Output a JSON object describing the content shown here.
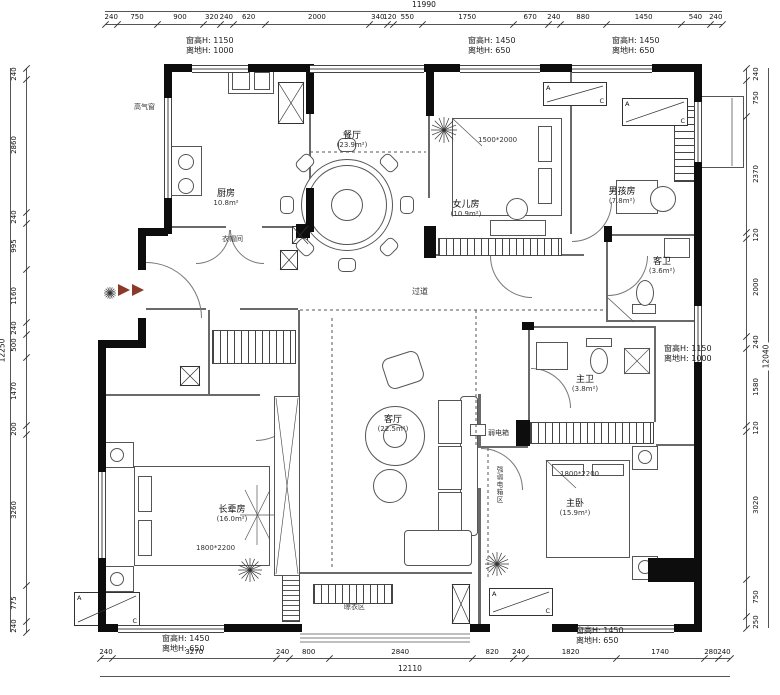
{
  "dims": {
    "top": {
      "total": "11990",
      "values": [
        "240",
        "750",
        "900",
        "320",
        "240",
        "620",
        "2000",
        "340",
        "120",
        "550",
        "1750",
        "670",
        "240",
        "880",
        "1450",
        "540",
        "240"
      ]
    },
    "bottom": {
      "total": "12110",
      "values": [
        "240",
        "3270",
        "240",
        "800",
        "2840",
        "820",
        "240",
        "1820",
        "1740",
        "280",
        "240"
      ]
    },
    "left": {
      "total": "12250",
      "values": [
        "240",
        "2860",
        "240",
        "995",
        "1160",
        "240",
        "500",
        "1470",
        "200",
        "3260",
        "775",
        "240"
      ]
    },
    "right": {
      "total": "12040",
      "values": [
        "240",
        "750",
        "2370",
        "120",
        "2000",
        "240",
        "1580",
        "120",
        "3020",
        "750",
        "250"
      ]
    }
  },
  "window_notes": [
    {
      "x": 186,
      "y": 36,
      "l1": "窗高H: 1150",
      "l2": "离地H: 1000"
    },
    {
      "x": 468,
      "y": 36,
      "l1": "窗高H: 1450",
      "l2": "离地H: 650"
    },
    {
      "x": 612,
      "y": 36,
      "l1": "窗高H: 1450",
      "l2": "离地H: 650"
    },
    {
      "x": 664,
      "y": 344,
      "l1": "窗高H: 1150",
      "l2": "离地H: 1000"
    },
    {
      "x": 162,
      "y": 634,
      "l1": "窗高H: 1450",
      "l2": "离地H: 650"
    },
    {
      "x": 576,
      "y": 626,
      "l1": "窗高H: 1450",
      "l2": "离地H: 650"
    }
  ],
  "rooms": [
    {
      "name": "厨房",
      "area": "10.8m²",
      "x": 226,
      "y": 198
    },
    {
      "name": "餐厅",
      "area": "(23.9m²)",
      "x": 352,
      "y": 140
    },
    {
      "name": "女儿房",
      "area": "(10.9m²)",
      "x": 466,
      "y": 209
    },
    {
      "name": "男孩房",
      "area": "(7.8m²)",
      "x": 622,
      "y": 196
    },
    {
      "name": "客卫",
      "area": "(3.6m²)",
      "x": 662,
      "y": 266
    },
    {
      "name": "主卫",
      "area": "(3.8m²)",
      "x": 585,
      "y": 384
    },
    {
      "name": "客厅",
      "area": "(22.5m²)",
      "x": 393,
      "y": 424
    },
    {
      "name": "主卧",
      "area": "(15.9m²)",
      "x": 575,
      "y": 508
    },
    {
      "name": "长辈房",
      "area": "(16.0m²)",
      "x": 232,
      "y": 514
    }
  ],
  "labels": [
    {
      "t": "过道",
      "x": 412,
      "y": 286,
      "fs": 8
    },
    {
      "t": "衣帽间",
      "x": 222,
      "y": 234,
      "fs": 7
    },
    {
      "t": "晾衣区",
      "x": 344,
      "y": 602,
      "fs": 7
    },
    {
      "t": "弱电箱",
      "x": 488,
      "y": 428,
      "fs": 7
    },
    {
      "t": "高气窗",
      "x": 134,
      "y": 102,
      "fs": 7
    },
    {
      "t": "1500*2000",
      "x": 478,
      "y": 136,
      "fs": 7
    },
    {
      "t": "1800*2200",
      "x": 560,
      "y": 470,
      "fs": 7
    },
    {
      "t": "1800*2200",
      "x": 196,
      "y": 544,
      "fs": 7
    },
    {
      "t": "强弱电箱区",
      "x": 494,
      "y": 466,
      "fs": 6.5,
      "v": true
    }
  ],
  "section_letters": {
    "a": "A",
    "c": "C"
  }
}
